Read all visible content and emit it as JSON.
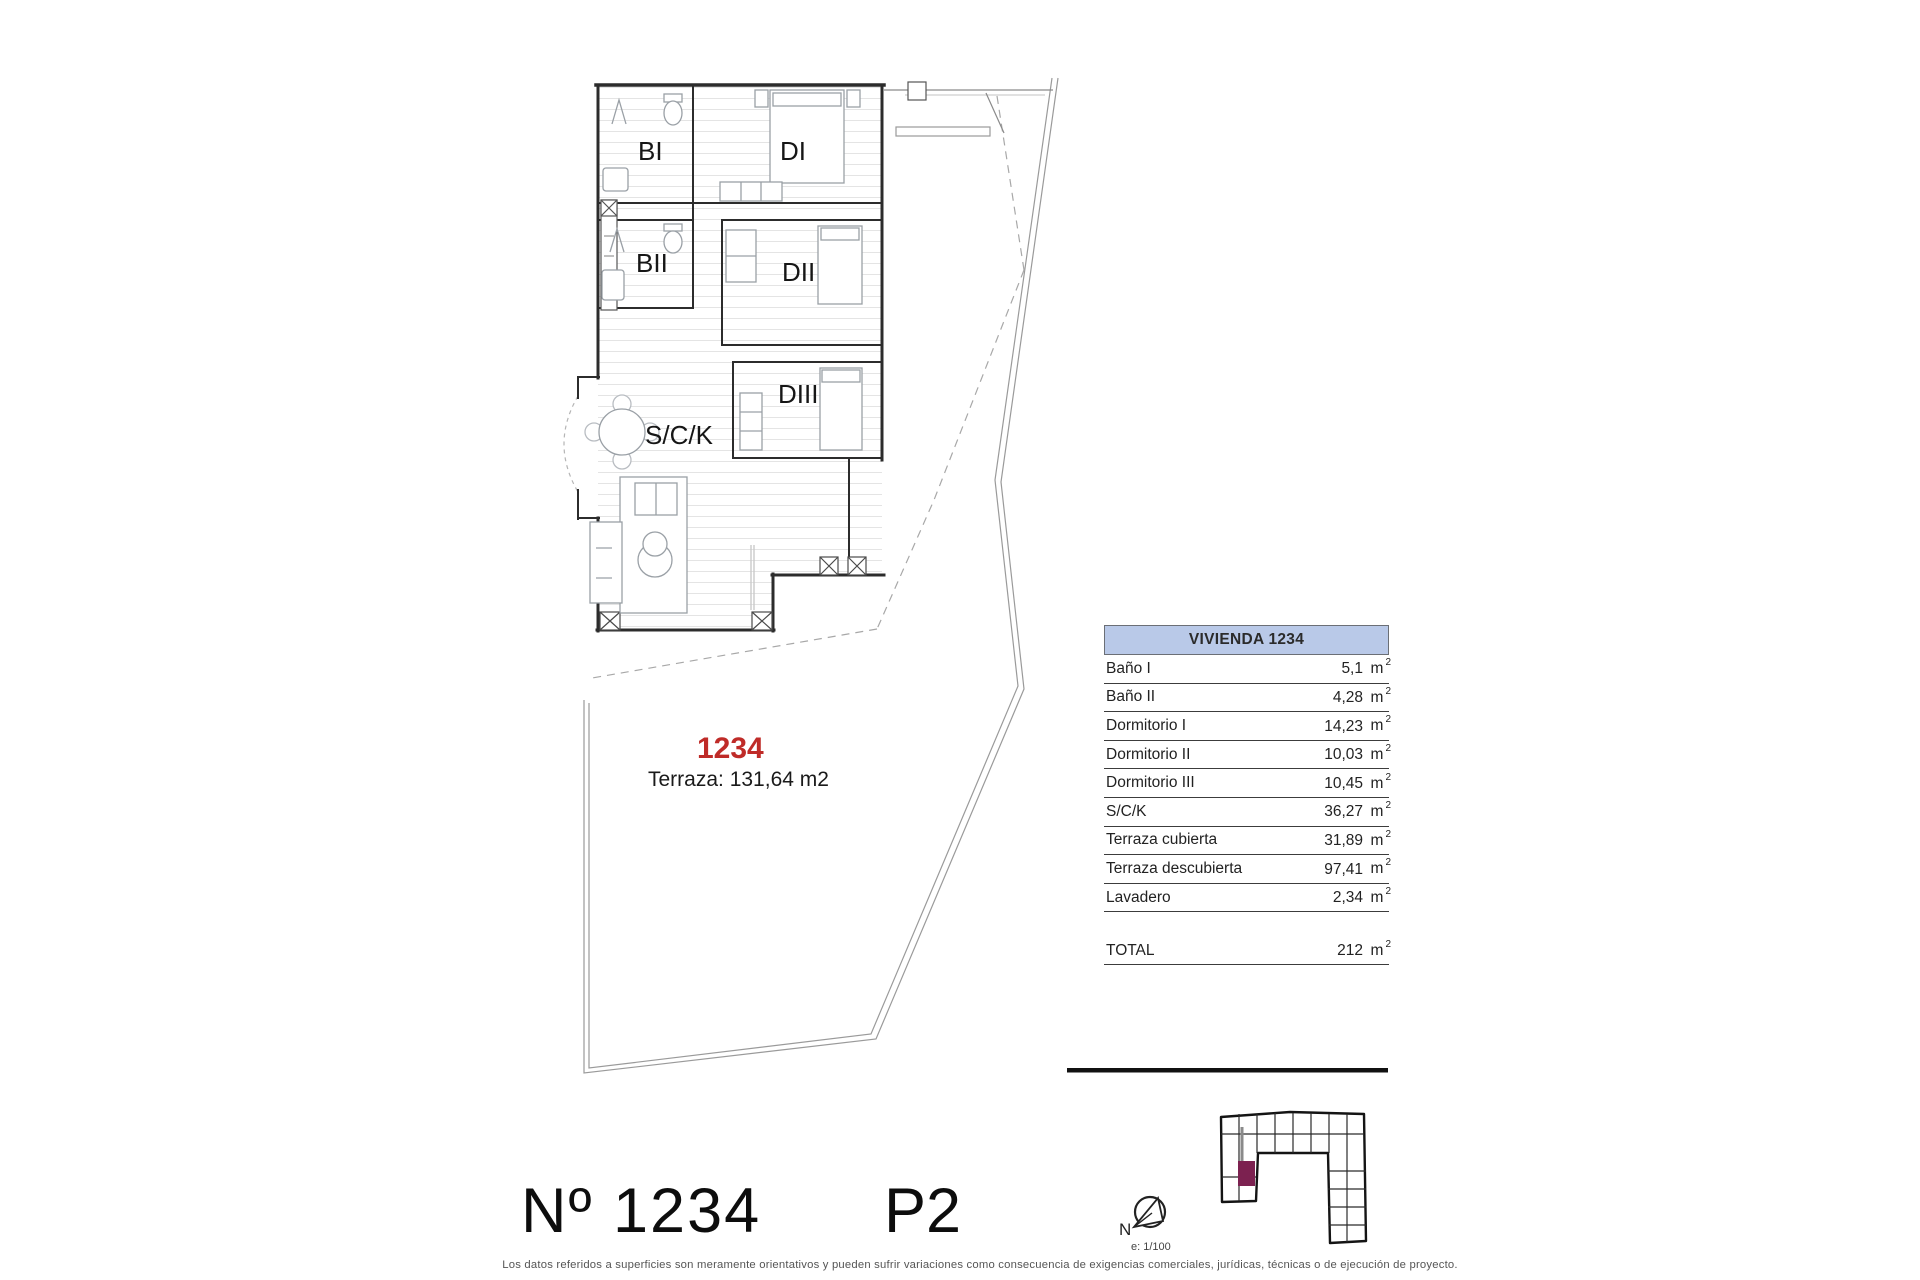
{
  "plan": {
    "unit_number_red": "1234",
    "terrace_note": "Terraza: 131,64 m2",
    "rooms": {
      "bi": "BI",
      "di": "DI",
      "bii": "BII",
      "dii": "DII",
      "diii": "DIII",
      "sck": "S/C/K"
    }
  },
  "area_table": {
    "header": "VIVIENDA 1234",
    "rows": [
      {
        "label": "Baño I",
        "value": "5,1"
      },
      {
        "label": "Baño II",
        "value": "4,28"
      },
      {
        "label": "Dormitorio I",
        "value": "14,23"
      },
      {
        "label": "Dormitorio II",
        "value": "10,03"
      },
      {
        "label": "Dormitorio III",
        "value": "10,45"
      },
      {
        "label": "S/C/K",
        "value": "36,27"
      },
      {
        "label": "Terraza cubierta",
        "value": "31,89"
      },
      {
        "label": "Terraza descubierta",
        "value": "97,41"
      },
      {
        "label": "Lavadero",
        "value": "2,34"
      }
    ],
    "total_label": "TOTAL",
    "total_value": "212",
    "unit": "m",
    "unit_sup": "2"
  },
  "footer": {
    "unit_title": "Nº 1234",
    "floor": "P2",
    "compass_letter": "N",
    "scale_note": "e: 1/100",
    "disclaimer": "Los datos referidos a superficies son meramente orientativos y pueden sufrir variaciones como consecuencia de exigencias comerciales, jurídicas, técnicas o de ejecución de proyecto."
  },
  "colors": {
    "table_header_bg": "#b9c9e8",
    "unit_number_red": "#bf2b28",
    "keyplan_highlight": "#7c2150",
    "wall": "#2c2c2c"
  }
}
